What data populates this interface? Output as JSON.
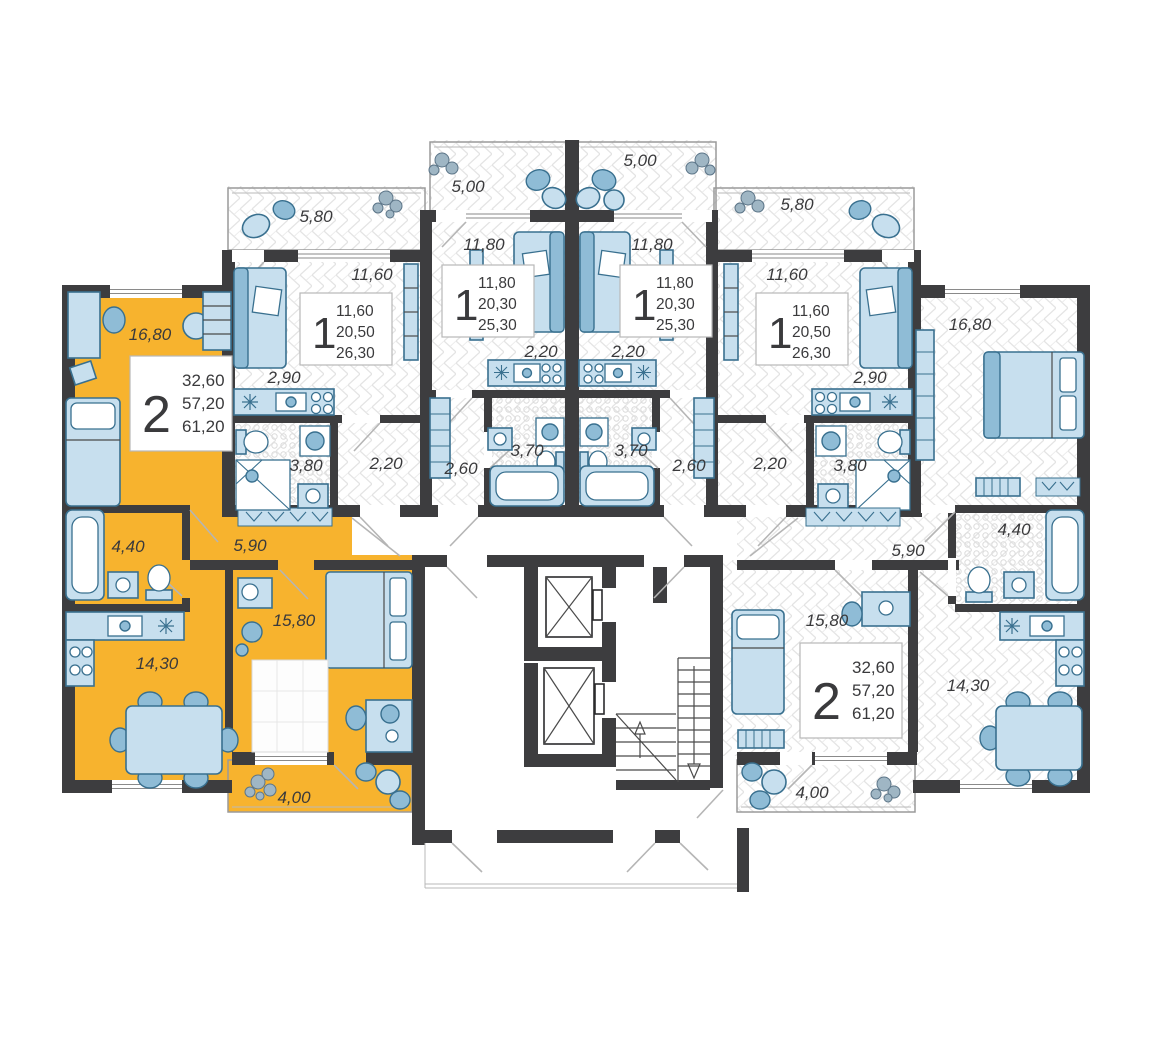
{
  "colors": {
    "highlight": "#F7B32E",
    "wall": "#3D3D3F",
    "furniture": "#C7DFEE"
  },
  "apartments": [
    {
      "id": "left-2-room",
      "highlighted": true,
      "type_label": "2",
      "areas": [
        "32,60",
        "57,20",
        "61,20"
      ],
      "rooms": {
        "bedroom": "16,80",
        "bath": "4,40",
        "hall": "5,90",
        "kitchen_living": "14,30",
        "bedroom2": "15,80",
        "balcony": "4,00"
      }
    },
    {
      "id": "left-1-room",
      "highlighted": false,
      "type_label": "1",
      "areas": [
        "11,60",
        "20,50",
        "26,30"
      ],
      "rooms": {
        "balcony": "5,80",
        "living": "11,60",
        "kitchen": "2,90",
        "bath": "3,80",
        "hall": "2,20"
      }
    },
    {
      "id": "center-left-1-room",
      "highlighted": false,
      "type_label": "1",
      "areas": [
        "11,80",
        "20,30",
        "25,30"
      ],
      "rooms": {
        "balcony": "5,00",
        "living": "11,80",
        "kitchen": "2,20",
        "bath": "3,70",
        "hall": "2,60"
      }
    },
    {
      "id": "center-right-1-room",
      "highlighted": false,
      "type_label": "1",
      "areas": [
        "11,80",
        "20,30",
        "25,30"
      ],
      "rooms": {
        "balcony": "5,00",
        "living": "11,80",
        "kitchen": "2,20",
        "bath": "3,70",
        "hall": "2,60"
      }
    },
    {
      "id": "right-1-room",
      "highlighted": false,
      "type_label": "1",
      "areas": [
        "11,60",
        "20,50",
        "26,30"
      ],
      "rooms": {
        "balcony": "5,80",
        "living": "11,60",
        "kitchen": "2,90",
        "bath": "3,80",
        "hall": "2,20"
      }
    },
    {
      "id": "right-2-room",
      "highlighted": false,
      "type_label": "2",
      "areas": [
        "32,60",
        "57,20",
        "61,20"
      ],
      "rooms": {
        "bedroom": "16,80",
        "bath": "4,40",
        "hall": "5,90",
        "kitchen_living": "14,30",
        "bedroom2": "15,80",
        "balcony": "4,00"
      }
    }
  ]
}
